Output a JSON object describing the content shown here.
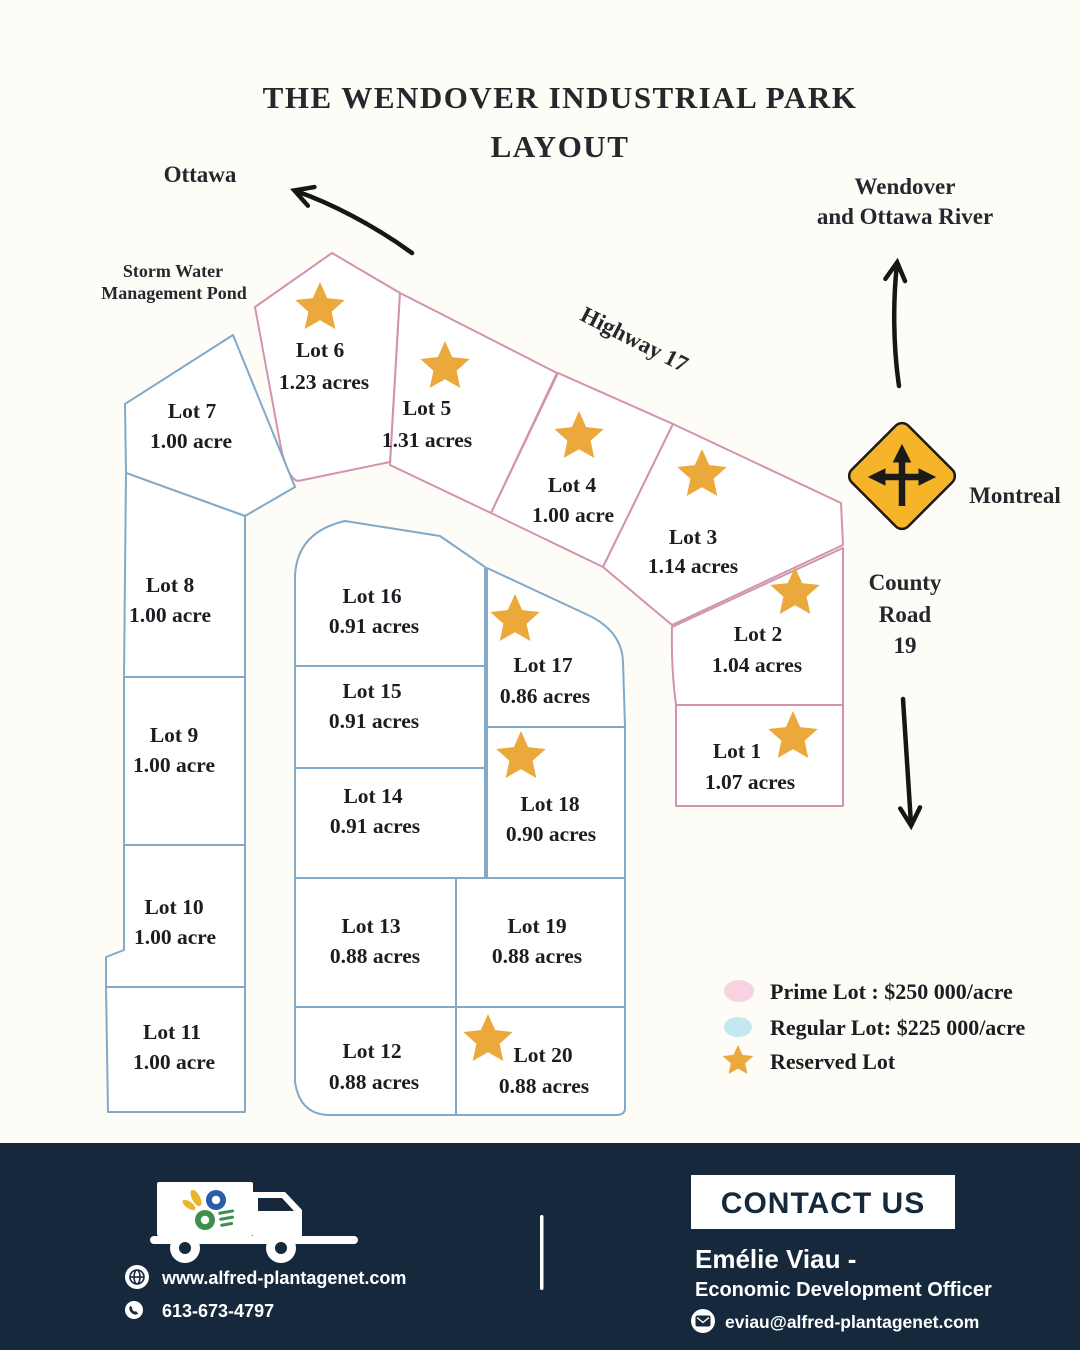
{
  "title": {
    "line1": "THE WENDOVER INDUSTRIAL PARK",
    "line2": "LAYOUT"
  },
  "directions": {
    "ottawa": "Ottawa",
    "wendover_line1": "Wendover",
    "wendover_line2": "and Ottawa River",
    "pond_line1": "Storm Water",
    "pond_line2": "Management Pond",
    "highway": "Highway 17",
    "montreal": "Montreal",
    "county_line1": "County",
    "county_line2": "Road",
    "county_line3": "19"
  },
  "lots": [
    {
      "name": "Lot 1",
      "size": "1.07 acres",
      "type": "prime",
      "reserved": true
    },
    {
      "name": "Lot 2",
      "size": "1.04 acres",
      "type": "prime",
      "reserved": true
    },
    {
      "name": "Lot 3",
      "size": "1.14 acres",
      "type": "prime",
      "reserved": true
    },
    {
      "name": "Lot 4",
      "size": "1.00 acre",
      "type": "prime",
      "reserved": true
    },
    {
      "name": "Lot 5",
      "size": "1.31 acres",
      "type": "prime",
      "reserved": true
    },
    {
      "name": "Lot 6",
      "size": "1.23 acres",
      "type": "prime",
      "reserved": true
    },
    {
      "name": "Lot 7",
      "size": "1.00 acre",
      "type": "regular",
      "reserved": false
    },
    {
      "name": "Lot 8",
      "size": "1.00 acre",
      "type": "regular",
      "reserved": false
    },
    {
      "name": "Lot 9",
      "size": "1.00 acre",
      "type": "regular",
      "reserved": false
    },
    {
      "name": "Lot 10",
      "size": "1.00 acre",
      "type": "regular",
      "reserved": false
    },
    {
      "name": "Lot 11",
      "size": "1.00 acre",
      "type": "regular",
      "reserved": false
    },
    {
      "name": "Lot 12",
      "size": "0.88 acres",
      "type": "regular",
      "reserved": false
    },
    {
      "name": "Lot 13",
      "size": "0.88 acres",
      "type": "regular",
      "reserved": false
    },
    {
      "name": "Lot 14",
      "size": "0.91 acres",
      "type": "regular",
      "reserved": false
    },
    {
      "name": "Lot 15",
      "size": "0.91 acres",
      "type": "regular",
      "reserved": false
    },
    {
      "name": "Lot 16",
      "size": "0.91 acres",
      "type": "regular",
      "reserved": false
    },
    {
      "name": "Lot 17",
      "size": "0.86 acres",
      "type": "regular",
      "reserved": true
    },
    {
      "name": "Lot 18",
      "size": "0.90 acres",
      "type": "regular",
      "reserved": true
    },
    {
      "name": "Lot 19",
      "size": "0.88 acres",
      "type": "regular",
      "reserved": false
    },
    {
      "name": "Lot 20",
      "size": "0.88 acres",
      "type": "regular",
      "reserved": true
    }
  ],
  "legend": {
    "prime": "Prime Lot : $250 000/acre",
    "regular": "Regular Lot: $225 000/acre",
    "reserved": "Reserved Lot"
  },
  "footer": {
    "website": "www.alfred-plantagenet.com",
    "phone": "613-673-4797",
    "contact_button": "CONTACT US",
    "contact_name": "Emélie Viau -",
    "contact_title": "Economic Development Officer",
    "email": "eviau@alfred-plantagenet.com"
  },
  "colors": {
    "background": "#fefcf7",
    "ink": "#26262c",
    "prime": "#d293ae",
    "regular": "#82a9c7",
    "star": "#eba93b",
    "legend-prime-fill": "#f7d3e1",
    "legend-regular-fill": "#c3e8f0",
    "sign-yellow": "#f6b428",
    "sign-ink": "#1a1a1a",
    "footer-bg": "#16293c"
  }
}
